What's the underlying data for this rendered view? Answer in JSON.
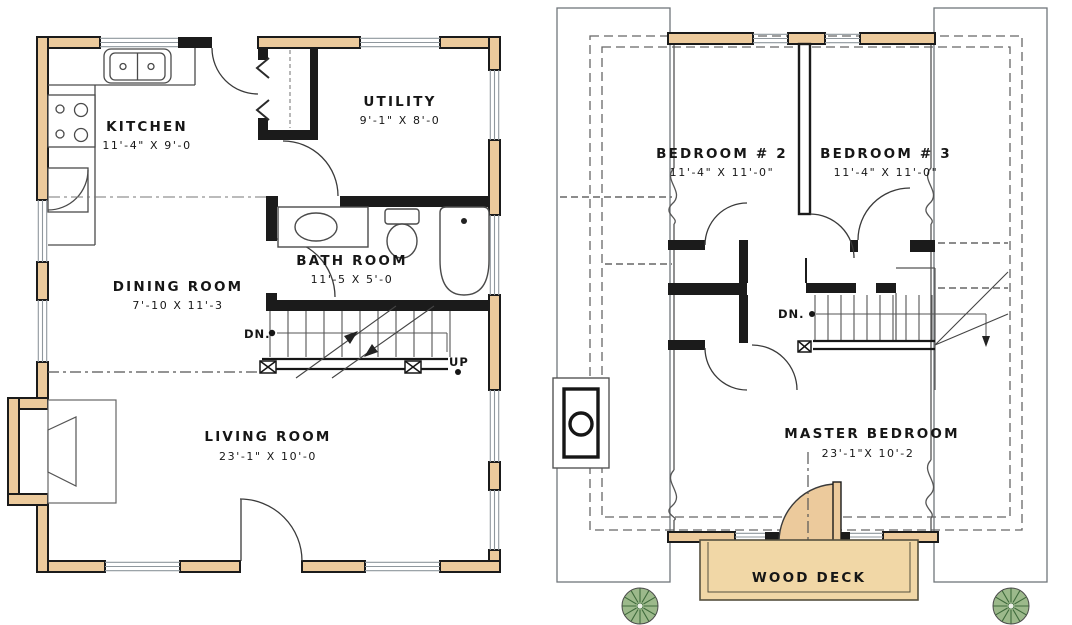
{
  "colors": {
    "wall_fill": "#ecca9c",
    "deck_fill": "#f1d7a6",
    "black_line": "#1b1b1b",
    "bush_green": "#9cb98b"
  },
  "first_floor": {
    "kitchen": {
      "name": "KITCHEN",
      "dims": "11'-4\" X 9'-0"
    },
    "utility": {
      "name": "UTILITY",
      "dims": "9'-1\" X 8'-0"
    },
    "dining": {
      "name": "DINING ROOM",
      "dims": "7'-10 X 11'-3"
    },
    "bath": {
      "name": "BATH ROOM",
      "dims": "11'-5 X 5'-0"
    },
    "living": {
      "name": "LIVING ROOM",
      "dims": "23'-1\" X 10'-0"
    },
    "stair_down_label": "DN.",
    "stair_up_label": "UP"
  },
  "second_floor": {
    "bedroom2": {
      "name": "BEDROOM # 2",
      "dims": "11'-4\" X 11'-0\""
    },
    "bedroom3": {
      "name": "BEDROOM # 3",
      "dims": "11'-4\" X 11'-0\""
    },
    "master": {
      "name": "MASTER BEDROOM",
      "dims": "23'-1\"X 10'-2"
    },
    "stair_down_label": "DN.",
    "deck_label": "WOOD DECK"
  }
}
